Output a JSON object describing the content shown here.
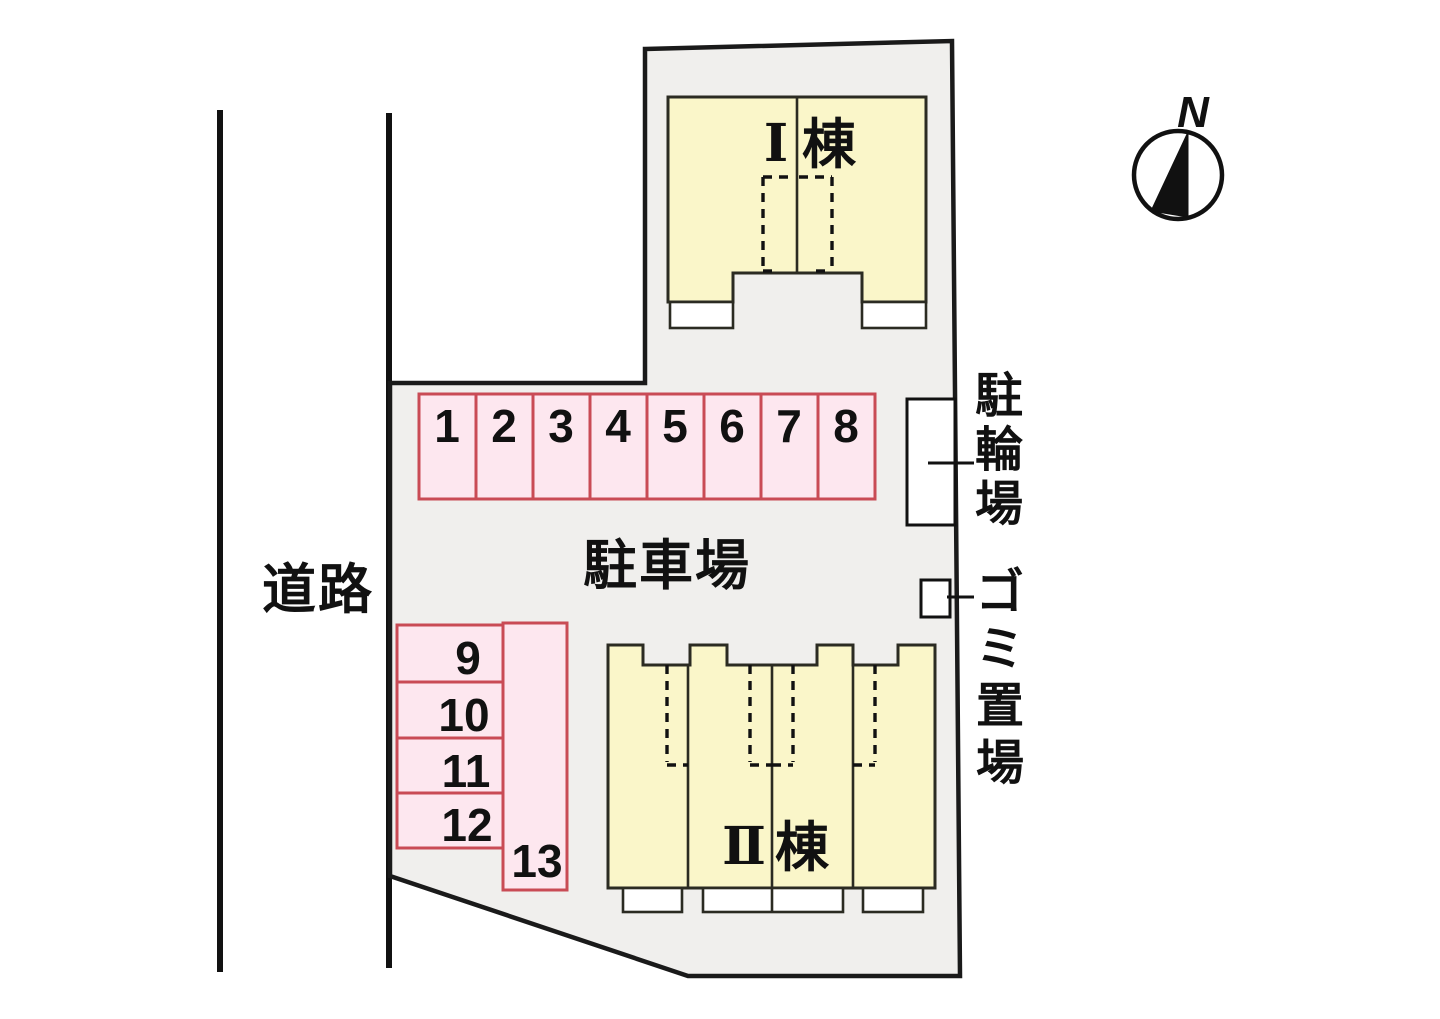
{
  "labels": {
    "road": "道路",
    "parking_lot": "駐車場",
    "bicycle_vertical": [
      "駐",
      "輪",
      "場"
    ],
    "garbage_vertical": [
      "ゴ",
      "ミ",
      "置",
      "場"
    ],
    "compass_north": "N"
  },
  "buildings": {
    "building1": {
      "numeral": "Ⅰ",
      "suffix": "棟",
      "units": 2
    },
    "building2": {
      "numeral": "Ⅱ",
      "suffix": "棟",
      "units": 4
    }
  },
  "parking": {
    "top_row": [
      "1",
      "2",
      "3",
      "4",
      "5",
      "6",
      "7",
      "8"
    ],
    "left_column": [
      "9",
      "10",
      "11",
      "12"
    ],
    "corner": "13",
    "total_spaces": 13
  },
  "colors": {
    "site_fill": "#f0efed",
    "site_outline": "#1a1a1a",
    "building_fill": "#faf6c9",
    "building_outline": "#2b2b22",
    "parking_fill": "#fde7ef",
    "parking_outline": "#c94b55",
    "porch_fill": "#ffffff",
    "line_color": "#111111"
  }
}
